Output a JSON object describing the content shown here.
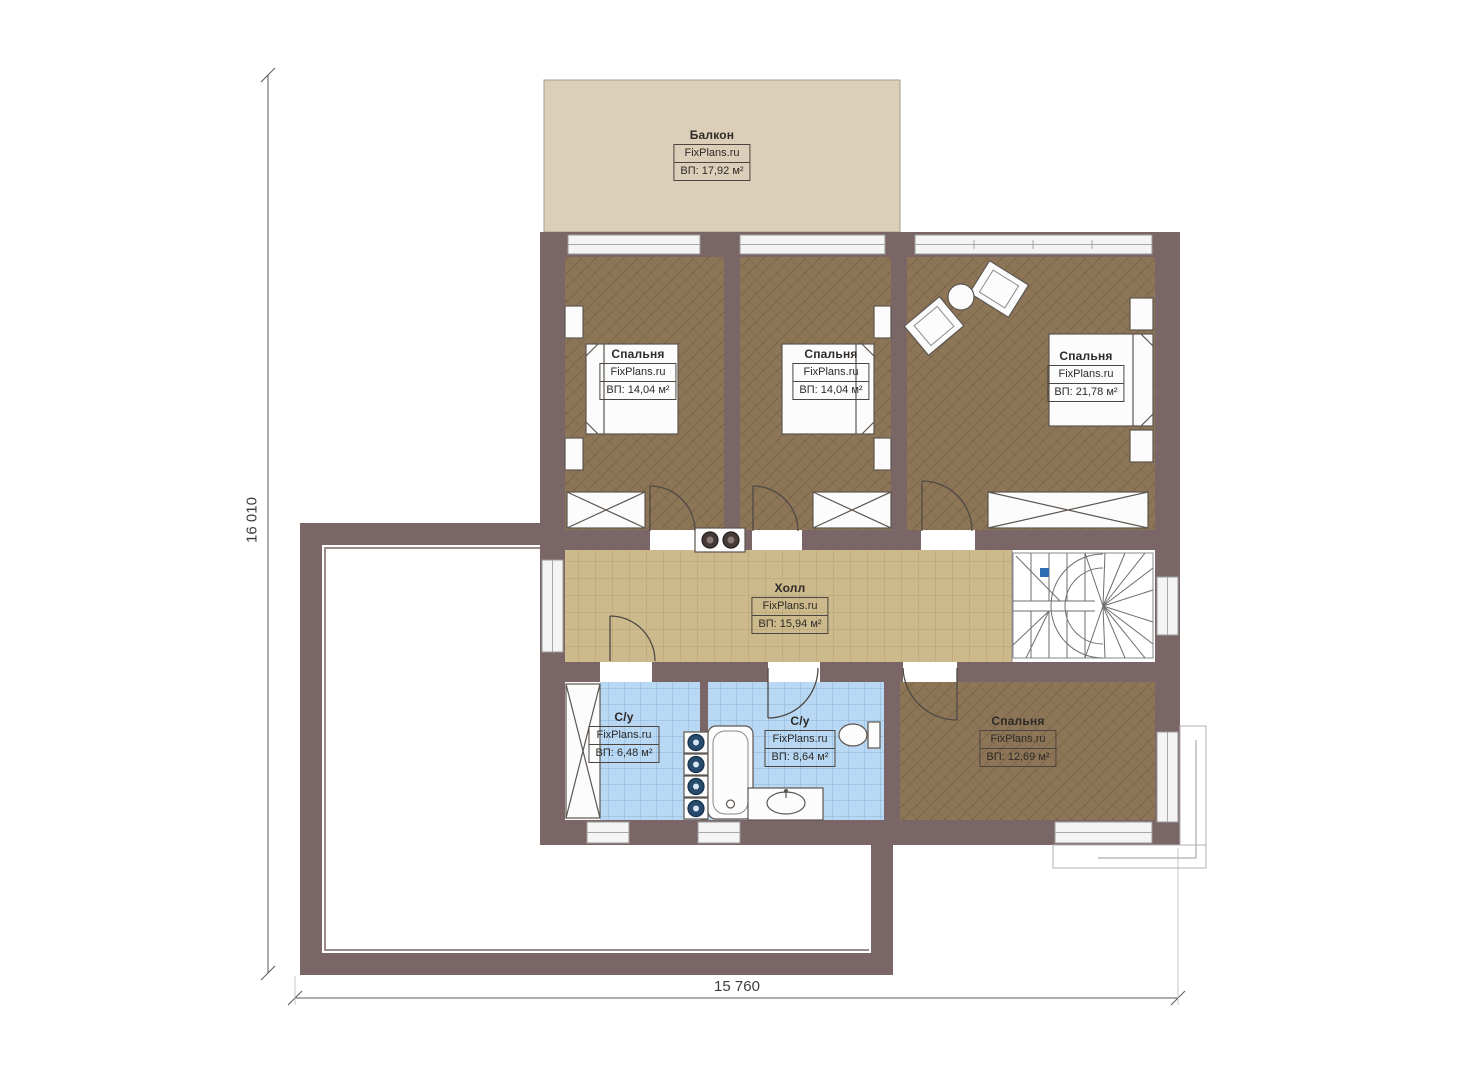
{
  "plan": {
    "watermark": "FixPlans.ru",
    "rooms": [
      {
        "id": "balcony",
        "name": "Балкон",
        "area_label": "ВП: 17,92 м²"
      },
      {
        "id": "bedroom-1",
        "name": "Спальня",
        "area_label": "ВП: 14,04 м²"
      },
      {
        "id": "bedroom-2",
        "name": "Спальня",
        "area_label": "ВП: 14,04 м²"
      },
      {
        "id": "bedroom-3",
        "name": "Спальня",
        "area_label": "ВП: 21,78 м²"
      },
      {
        "id": "hall",
        "name": "Холл",
        "area_label": "ВП: 15,94 м²"
      },
      {
        "id": "bathroom-1",
        "name": "С/у",
        "area_label": "ВП: 6,48 м²"
      },
      {
        "id": "bathroom-2",
        "name": "С/у",
        "area_label": "ВП: 8,64 м²"
      },
      {
        "id": "bedroom-4",
        "name": "Спальня",
        "area_label": "ВП: 12,69 м²"
      }
    ],
    "dimensions": {
      "height_label": "16 010",
      "width_label": "15 760"
    },
    "colors": {
      "wall": "#7b6667",
      "bedroom_floor": "#8d7557",
      "hall_tile": "#cdba8c",
      "bath_tile": "#b9d8f3",
      "balcony": "#dbcfba",
      "stair_marker": "#2e6db2"
    }
  }
}
